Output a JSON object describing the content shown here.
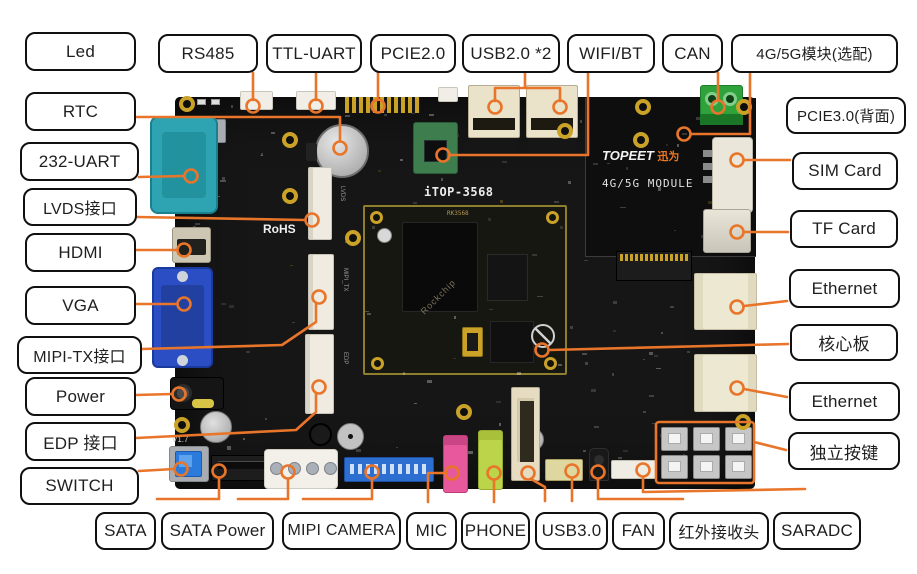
{
  "diagram_title": "iTOP-3568 development board interface diagram",
  "labels": {
    "left": [
      "Led",
      "RTC",
      "232-UART",
      "LVDS接口",
      "HDMI",
      "VGA",
      "MIPI-TX接口",
      "Power",
      "EDP 接口",
      "SWITCH"
    ],
    "top": [
      "RS485",
      "TTL-UART",
      "PCIE2.0",
      "USB2.0 *2",
      "WIFI/BT",
      "CAN",
      "4G/5G模块(选配)"
    ],
    "right": [
      "PCIE3.0(背面)",
      "SIM Card",
      "TF Card",
      "Ethernet",
      "核心板",
      "Ethernet",
      "独立按键"
    ],
    "bottom": [
      "SATA",
      "SATA Power",
      "MIPI CAMERA",
      "MIC",
      "PHONE",
      "USB3.0",
      "FAN",
      "红外接收头",
      "SARADC"
    ]
  },
  "board_silkscreen": {
    "model": "iTOP-3568",
    "soc": "RK3568",
    "soc_brand": "Rockchip",
    "rohs": "RoHS",
    "version": "V1.7",
    "brand_en": "TOPEET",
    "brand_cn": "迅为",
    "module_zone": "4G/5G MODULE"
  },
  "connector_silkscreen": {
    "lvds": "LVDS",
    "mipi_tx": "MIPI_TX",
    "edp": "EDP"
  },
  "colors": {
    "leader_orange": "#E8752A",
    "board_black": "#161616",
    "label_bg": "#FFFFFF",
    "label_border": "#101010",
    "gold": "#C9A227",
    "brand_orange": "#E87722"
  }
}
